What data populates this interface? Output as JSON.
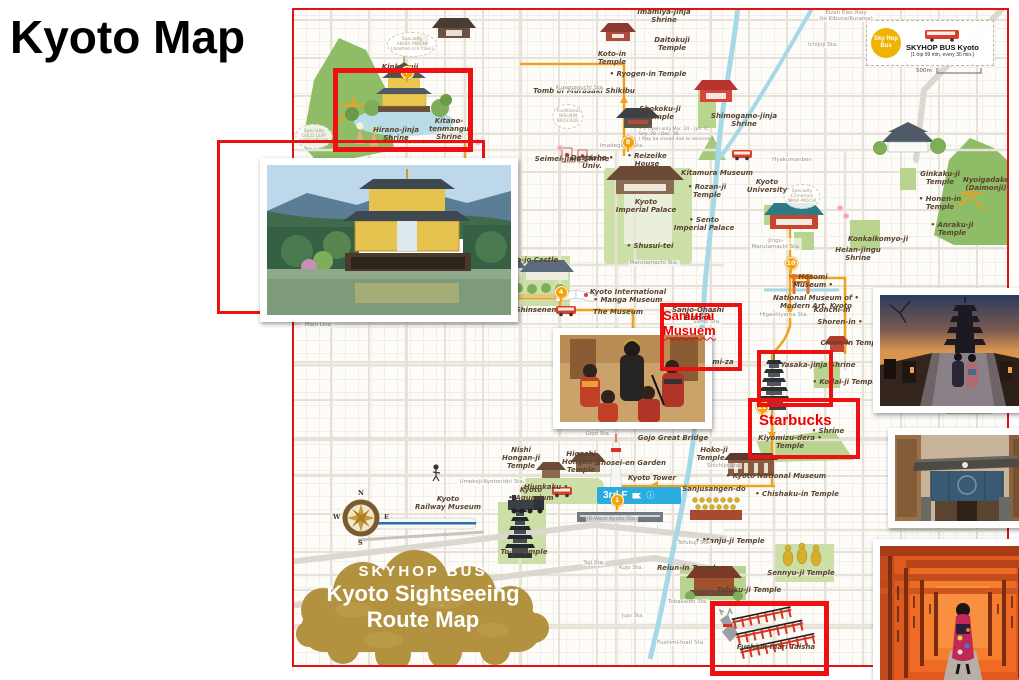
{
  "slide": {
    "title": "Kyoto Map"
  },
  "legend": {
    "badge_line1": "Sky Hop",
    "badge_line2": "Bus",
    "title": "SKYHOP BUS Kyoto",
    "subtitle": "(1 trip 99 min, every 30 min.)",
    "scale_label": "500m"
  },
  "cloud": {
    "line1": "SKYHOP BUS",
    "line2": "Kyoto Sightseeing",
    "line3": "Route Map"
  },
  "compass": {
    "n": "N",
    "e": "E",
    "s": "S",
    "w": "W"
  },
  "ribbon": {
    "text": "3rd F",
    "info": "ⓘ"
  },
  "annotations": {
    "samurai": {
      "line1": "Samurai",
      "line2": "Musuem"
    },
    "starbucks": {
      "text": "Starbucks"
    }
  },
  "colors": {
    "highlight_red": "#ee1111",
    "route_gold": "#efa31d",
    "river_blue": "#a6d9e8",
    "cloud_gold": "#b2923f",
    "legend_yellow": "#f0b400"
  },
  "labels": [
    {
      "t": "Imamiya-jinja\nShrine",
      "x": 664,
      "y": 8
    },
    {
      "t": "Daitokuji\nTemple",
      "x": 672,
      "y": 36
    },
    {
      "t": "Koto-in\nTemple",
      "x": 612,
      "y": 50
    },
    {
      "t": "• Ryogen-in Temple",
      "x": 648,
      "y": 70
    },
    {
      "t": "Tomb of Murasaki Shikibu",
      "x": 584,
      "y": 87
    },
    {
      "t": "Kinkakuji\nTemple",
      "x": 400,
      "y": 63
    },
    {
      "t": "Hirano-jinja\nShrine",
      "x": 396,
      "y": 126
    },
    {
      "t": "Kitano-\ntenmangu\nShrine",
      "x": 449,
      "y": 117
    },
    {
      "t": "Shokoku-ji\nTemple",
      "x": 660,
      "y": 105
    },
    {
      "t": "Shimogamo-jinja\nShrine",
      "x": 744,
      "y": 112
    },
    {
      "t": "Seimei-jinja Shrine",
      "x": 572,
      "y": 155
    },
    {
      "t": "Doshisha •\nUniv.",
      "x": 592,
      "y": 154
    },
    {
      "t": "• Reizeike\nHouse",
      "x": 647,
      "y": 152
    },
    {
      "t": "Kitamura Museum",
      "x": 717,
      "y": 169
    },
    {
      "t": "• Rozan-ji\nTemple",
      "x": 707,
      "y": 183
    },
    {
      "t": "Kyoto\nUniversity",
      "x": 767,
      "y": 178
    },
    {
      "t": "Kyoto\nImperial Palace",
      "x": 646,
      "y": 198
    },
    {
      "t": "• Sento\nImperial Palace",
      "x": 704,
      "y": 216
    },
    {
      "t": "• Shusui-tei",
      "x": 650,
      "y": 242
    },
    {
      "t": "Ginkaku-ji\nTemple",
      "x": 940,
      "y": 170
    },
    {
      "t": "Nyoigadake\n(Daimonji)",
      "x": 986,
      "y": 176
    },
    {
      "t": "• Honen-in\nTemple",
      "x": 940,
      "y": 195
    },
    {
      "t": "• Anraku-ji Temple",
      "x": 952,
      "y": 221
    },
    {
      "t": "Konkaikomyo-ji",
      "x": 878,
      "y": 235
    },
    {
      "t": "Heian-jingu\nShrine",
      "x": 858,
      "y": 246
    },
    {
      "t": "Hosomi\nMuseum •",
      "x": 813,
      "y": 273
    },
    {
      "t": "National Museum of •\nModern Art, Kyoto",
      "x": 816,
      "y": 294
    },
    {
      "t": "Kyoto International\n• Manga Museum",
      "x": 628,
      "y": 288
    },
    {
      "t": "The Museum",
      "x": 618,
      "y": 308
    },
    {
      "t": "Nijo-jo Castle",
      "x": 532,
      "y": 256
    },
    {
      "t": "Shinsenen",
      "x": 536,
      "y": 306
    },
    {
      "t": "Sanjo-Ohashi\nBridge",
      "x": 698,
      "y": 306
    },
    {
      "t": "• Minami-za",
      "x": 710,
      "y": 358
    },
    {
      "t": "Yasaka-jinja Shrine",
      "x": 818,
      "y": 361
    },
    {
      "t": "Chion-in Temple",
      "x": 852,
      "y": 339
    },
    {
      "t": "Shoren-in •",
      "x": 840,
      "y": 318
    },
    {
      "t": "Konchi-in",
      "x": 832,
      "y": 306
    },
    {
      "t": "• Kodai-ji Temple",
      "x": 846,
      "y": 378
    },
    {
      "t": "Kennin-ji\nTemple",
      "x": 662,
      "y": 386
    },
    {
      "t": "Kiyomizu-dera •\nTemple",
      "x": 790,
      "y": 434
    },
    {
      "t": "• Shrine",
      "x": 828,
      "y": 427
    },
    {
      "t": "Gojo Great Bridge",
      "x": 673,
      "y": 434
    },
    {
      "t": "Hoko-ji\nTemple •",
      "x": 714,
      "y": 446
    },
    {
      "t": "Shosei-en Garden",
      "x": 631,
      "y": 459
    },
    {
      "t": "Kyoto Tower",
      "x": 652,
      "y": 474
    },
    {
      "t": "Higashi\nHongan-ji\nTemple",
      "x": 581,
      "y": 450
    },
    {
      "t": "Nishi\nHongan-ji\nTemple",
      "x": 521,
      "y": 446
    },
    {
      "t": "Hiunkaku •",
      "x": 546,
      "y": 483
    },
    {
      "t": "Kyoto\n• Aquarium",
      "x": 531,
      "y": 486
    },
    {
      "t": "• Kyoto National Museum",
      "x": 776,
      "y": 472
    },
    {
      "t": "Sanjusangen-do",
      "x": 714,
      "y": 485
    },
    {
      "t": "• Chishaku-in Temple",
      "x": 797,
      "y": 490
    },
    {
      "t": "Kyoto\nRailway Museum",
      "x": 448,
      "y": 495
    },
    {
      "t": "To-ji Temple",
      "x": 524,
      "y": 548
    },
    {
      "t": "• Manju-ji Temple",
      "x": 730,
      "y": 537
    },
    {
      "t": "Reiun-in Temple •",
      "x": 692,
      "y": 564
    },
    {
      "t": "Sennyu-ji Temple",
      "x": 801,
      "y": 569
    },
    {
      "t": "Tofuku-ji Temple",
      "x": 749,
      "y": 586
    },
    {
      "t": "Mausoleum of",
      "x": 966,
      "y": 395
    },
    {
      "t": "Fushimi Inari Taisha",
      "x": 776,
      "y": 643
    },
    {
      "t": "Eizan Elec.Rwy\n(to Kibune/Kurama)",
      "x": 846,
      "y": 10,
      "c": "s"
    },
    {
      "t": "Ichijoji Sta.",
      "x": 823,
      "y": 42,
      "c": "s"
    },
    {
      "t": "Kuramaguchi Sta.",
      "x": 580,
      "y": 85,
      "c": "s"
    },
    {
      "t": "Imadegawa Sta.",
      "x": 622,
      "y": 143,
      "c": "s"
    },
    {
      "t": "Hyakumanben",
      "x": 792,
      "y": 157,
      "c": "s"
    },
    {
      "t": "Marutamachi Sta.",
      "x": 654,
      "y": 260,
      "c": "s"
    },
    {
      "t": "Jingu-\nMarutamachi Sta.",
      "x": 776,
      "y": 238,
      "c": "s"
    },
    {
      "t": "Nijo Sta.",
      "x": 502,
      "y": 299,
      "c": "s"
    },
    {
      "t": "Sanjo Sta.",
      "x": 707,
      "y": 319,
      "c": "s"
    },
    {
      "t": "Higashiyama Sta.",
      "x": 784,
      "y": 312,
      "c": "s"
    },
    {
      "t": "Kawaramachi Sta.",
      "x": 660,
      "y": 349,
      "c": "s"
    },
    {
      "t": "Gion-Shijo Sta.",
      "x": 670,
      "y": 375,
      "c": "s"
    },
    {
      "t": "Kiyomizu Gojo Sta.",
      "x": 662,
      "y": 410,
      "c": "s"
    },
    {
      "t": "Gojo Sta.",
      "x": 598,
      "y": 431,
      "c": "s"
    },
    {
      "t": "Shichijo Sta.",
      "x": 724,
      "y": 463,
      "c": "s"
    },
    {
      "t": "Umekoji-Kyotonishi Sta.",
      "x": 492,
      "y": 479,
      "c": "s"
    },
    {
      "t": "JR-West Kyoto Sta.",
      "x": 612,
      "y": 516,
      "c": "s"
    },
    {
      "t": "Toji Sta.",
      "x": 594,
      "y": 560,
      "c": "s"
    },
    {
      "t": "Tofukuji Sta.",
      "x": 694,
      "y": 540,
      "c": "s"
    },
    {
      "t": "Tobakaido Sta.",
      "x": 688,
      "y": 599,
      "c": "s"
    },
    {
      "t": "Fushimi-Inari Sta.",
      "x": 681,
      "y": 640,
      "c": "s"
    },
    {
      "t": "Jujo Sta.",
      "x": 633,
      "y": 613,
      "c": "s"
    },
    {
      "t": "Kujo Sta.",
      "x": 631,
      "y": 565,
      "c": "s"
    },
    {
      "t": "Randen\nArashiyama\nMain Line",
      "x": 318,
      "y": 310,
      "c": "s"
    },
    {
      "t": "Specialty\nABURI MOCHI\n(roasted rice cake)",
      "x": 412,
      "y": 32,
      "c": "n"
    },
    {
      "t": "Specialty\nGOLD LEAF\nSOFT CREAM",
      "x": 314,
      "y": 124,
      "c": "n"
    },
    {
      "t": "Traditional\nNISHIJIN\nBROCADE",
      "x": 568,
      "y": 104,
      "c": "n"
    },
    {
      "t": "Specialty\nCinnamon\nNIKKI-MOCHI",
      "x": 802,
      "y": 184,
      "c": "n"
    },
    {
      "t": "• = Open only Mar. 24 – Jun. 4,\nSep. 26 – Dec. 18.\n( May be closed due to services )",
      "x": 676,
      "y": 127,
      "c": "o"
    }
  ],
  "stops": [
    {
      "n": "7",
      "x": 406,
      "y": 71
    },
    {
      "n": "8",
      "x": 627,
      "y": 141
    },
    {
      "n": "6",
      "x": 477,
      "y": 297
    },
    {
      "n": "4",
      "x": 560,
      "y": 291
    },
    {
      "n": "10",
      "x": 790,
      "y": 262
    },
    {
      "n": "11",
      "x": 761,
      "y": 406
    },
    {
      "n": "1",
      "x": 616,
      "y": 499
    }
  ],
  "boxes": [
    {
      "x": 333,
      "y": 68,
      "w": 130,
      "h": 74,
      "b": 5,
      "z": 5
    },
    {
      "x": 217,
      "y": 140,
      "w": 262,
      "h": 168,
      "b": 3,
      "z": 5
    },
    {
      "x": 660,
      "y": 303,
      "w": 74,
      "h": 60,
      "b": 4,
      "z": 8
    },
    {
      "x": 757,
      "y": 350,
      "w": 68,
      "h": 49,
      "b": 4,
      "z": 8
    },
    {
      "x": 748,
      "y": 398,
      "w": 104,
      "h": 53,
      "b": 4,
      "z": 8
    },
    {
      "x": 710,
      "y": 601,
      "w": 109,
      "h": 65,
      "b": 5,
      "z": 7
    }
  ]
}
